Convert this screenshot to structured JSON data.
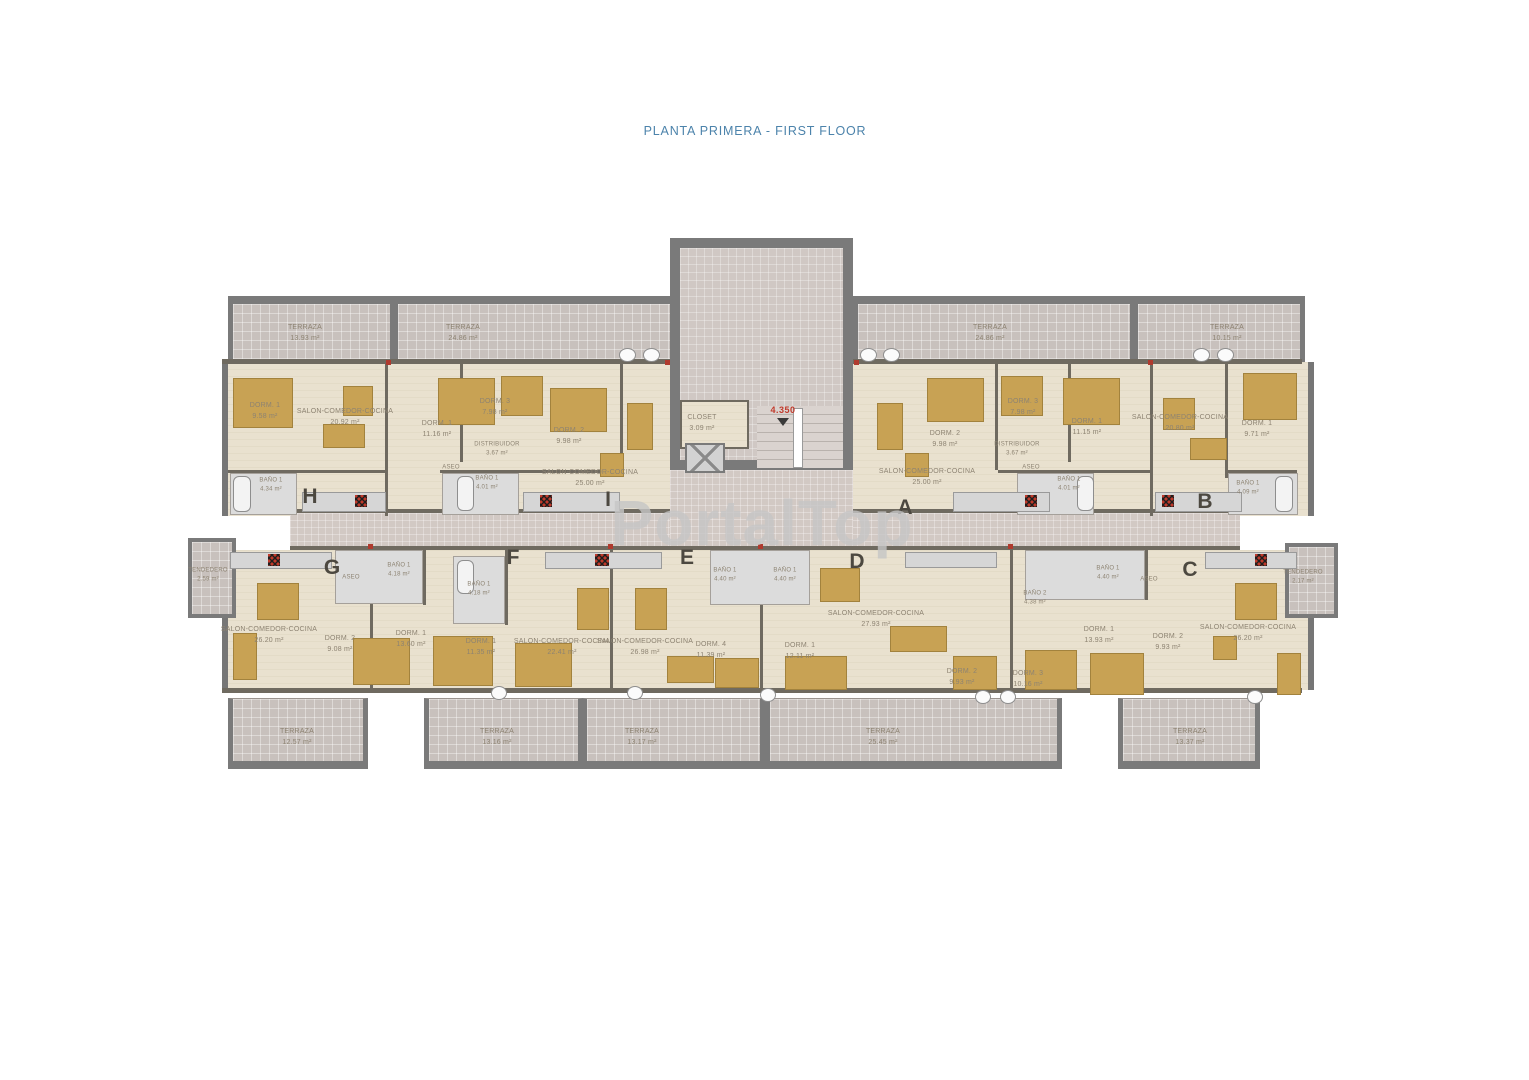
{
  "title": "PLANTA PRIMERA  - FIRST FLOOR",
  "watermark": "PortalTop",
  "core": {
    "closet": {
      "name": "CLOSET",
      "area": "3.09 m²"
    },
    "level": "4.350"
  },
  "terraces": {
    "top": [
      {
        "name": "TERRAZA",
        "area": "13.93 m²"
      },
      {
        "name": "TERRAZA",
        "area": "24.86 m²"
      },
      {
        "name": "TERRAZA",
        "area": "24.86 m²"
      },
      {
        "name": "TERRAZA",
        "area": "10.15 m²"
      }
    ],
    "bottom": [
      {
        "name": "TERRAZA",
        "area": "12.57 m²"
      },
      {
        "name": "TERRAZA",
        "area": "13.16 m²"
      },
      {
        "name": "TERRAZA",
        "area": "13.17 m²"
      },
      {
        "name": "TERRAZA",
        "area": "25.45 m²"
      },
      {
        "name": "TERRAZA",
        "area": "13.37 m²"
      }
    ]
  },
  "apartments": {
    "h": {
      "letter": "H",
      "rooms": [
        {
          "name": "DORM. 1",
          "area": "9.58 m²"
        },
        {
          "name": "SALON-COMEDOR-COCINA",
          "area": "20.92 m²"
        },
        {
          "name": "BAÑO 1",
          "area": "4.34 m²"
        }
      ]
    },
    "i": {
      "letter": "I",
      "rooms": [
        {
          "name": "DORM. 1",
          "area": "11.16 m²"
        },
        {
          "name": "DORM. 3",
          "area": "7.98 m²"
        },
        {
          "name": "DORM. 2",
          "area": "9.98 m²"
        },
        {
          "name": "DISTRIBUIDOR",
          "area": "3.67 m²"
        },
        {
          "name": "ASEO",
          "area": ""
        },
        {
          "name": "BAÑO 1",
          "area": "4.01 m²"
        },
        {
          "name": "SALON-COMEDOR-COCINA",
          "area": "25.00 m²"
        }
      ]
    },
    "a": {
      "letter": "A",
      "rooms": [
        {
          "name": "SALON-COMEDOR-COCINA",
          "area": "25.00 m²"
        },
        {
          "name": "DORM. 2",
          "area": "9.98 m²"
        },
        {
          "name": "DORM. 3",
          "area": "7.98 m²"
        },
        {
          "name": "DISTRIBUIDOR",
          "area": "3.67 m²"
        },
        {
          "name": "DORM. 1",
          "area": "11.15 m²"
        },
        {
          "name": "ASEO",
          "area": ""
        },
        {
          "name": "BAÑO 1",
          "area": "4.01 m²"
        }
      ]
    },
    "b": {
      "letter": "B",
      "rooms": [
        {
          "name": "SALON-COMEDOR-COCINA",
          "area": "20.80 m²"
        },
        {
          "name": "DORM. 1",
          "area": "9.71 m²"
        },
        {
          "name": "BAÑO 1",
          "area": "4.09 m²"
        }
      ]
    },
    "g": {
      "letter": "G",
      "rooms": [
        {
          "name": "TENDEDERO",
          "area": "2.59 m²"
        },
        {
          "name": "ASEO",
          "area": ""
        },
        {
          "name": "BAÑO 1",
          "area": "4.18 m²"
        },
        {
          "name": "SALON-COMEDOR-COCINA",
          "area": "26.20 m²"
        },
        {
          "name": "DORM. 2",
          "area": "9.08 m²"
        },
        {
          "name": "DORM. 1",
          "area": "13.60 m²"
        }
      ]
    },
    "f": {
      "letter": "F",
      "rooms": [
        {
          "name": "BAÑO 1",
          "area": "4.18 m²"
        },
        {
          "name": "DORM. 1",
          "area": "11.35 m²"
        },
        {
          "name": "SALON-COMEDOR-COCINA",
          "area": "22.41 m²"
        }
      ]
    },
    "e": {
      "letter": "E",
      "rooms": [
        {
          "name": "SALON-COMEDOR-COCINA",
          "area": "26.98 m²"
        },
        {
          "name": "BAÑO 1",
          "area": "4.40 m²"
        },
        {
          "name": "DORM. 4",
          "area": "11.39 m²"
        }
      ]
    },
    "d": {
      "letter": "D",
      "rooms": [
        {
          "name": "BAÑO 1",
          "area": "4.40 m²"
        },
        {
          "name": "SALON-COMEDOR-COCINA",
          "area": "27.93 m²"
        },
        {
          "name": "DORM. 1",
          "area": "12.11 m²"
        },
        {
          "name": "DORM. 2",
          "area": "9.93 m²"
        },
        {
          "name": "DORM. 3",
          "area": "10.16 m²"
        }
      ]
    },
    "c": {
      "letter": "C",
      "rooms": [
        {
          "name": "BAÑO 2",
          "area": "4.38 m²"
        },
        {
          "name": "BAÑO 1",
          "area": "4.40 m²"
        },
        {
          "name": "ASEO",
          "area": ""
        },
        {
          "name": "DORM. 1",
          "area": "13.93 m²"
        },
        {
          "name": "DORM. 2",
          "area": "9.93 m²"
        },
        {
          "name": "SALON-COMEDOR-COCINA",
          "area": "26.20 m²"
        },
        {
          "name": "TENDEDERO",
          "area": "2.17 m²"
        }
      ]
    }
  }
}
